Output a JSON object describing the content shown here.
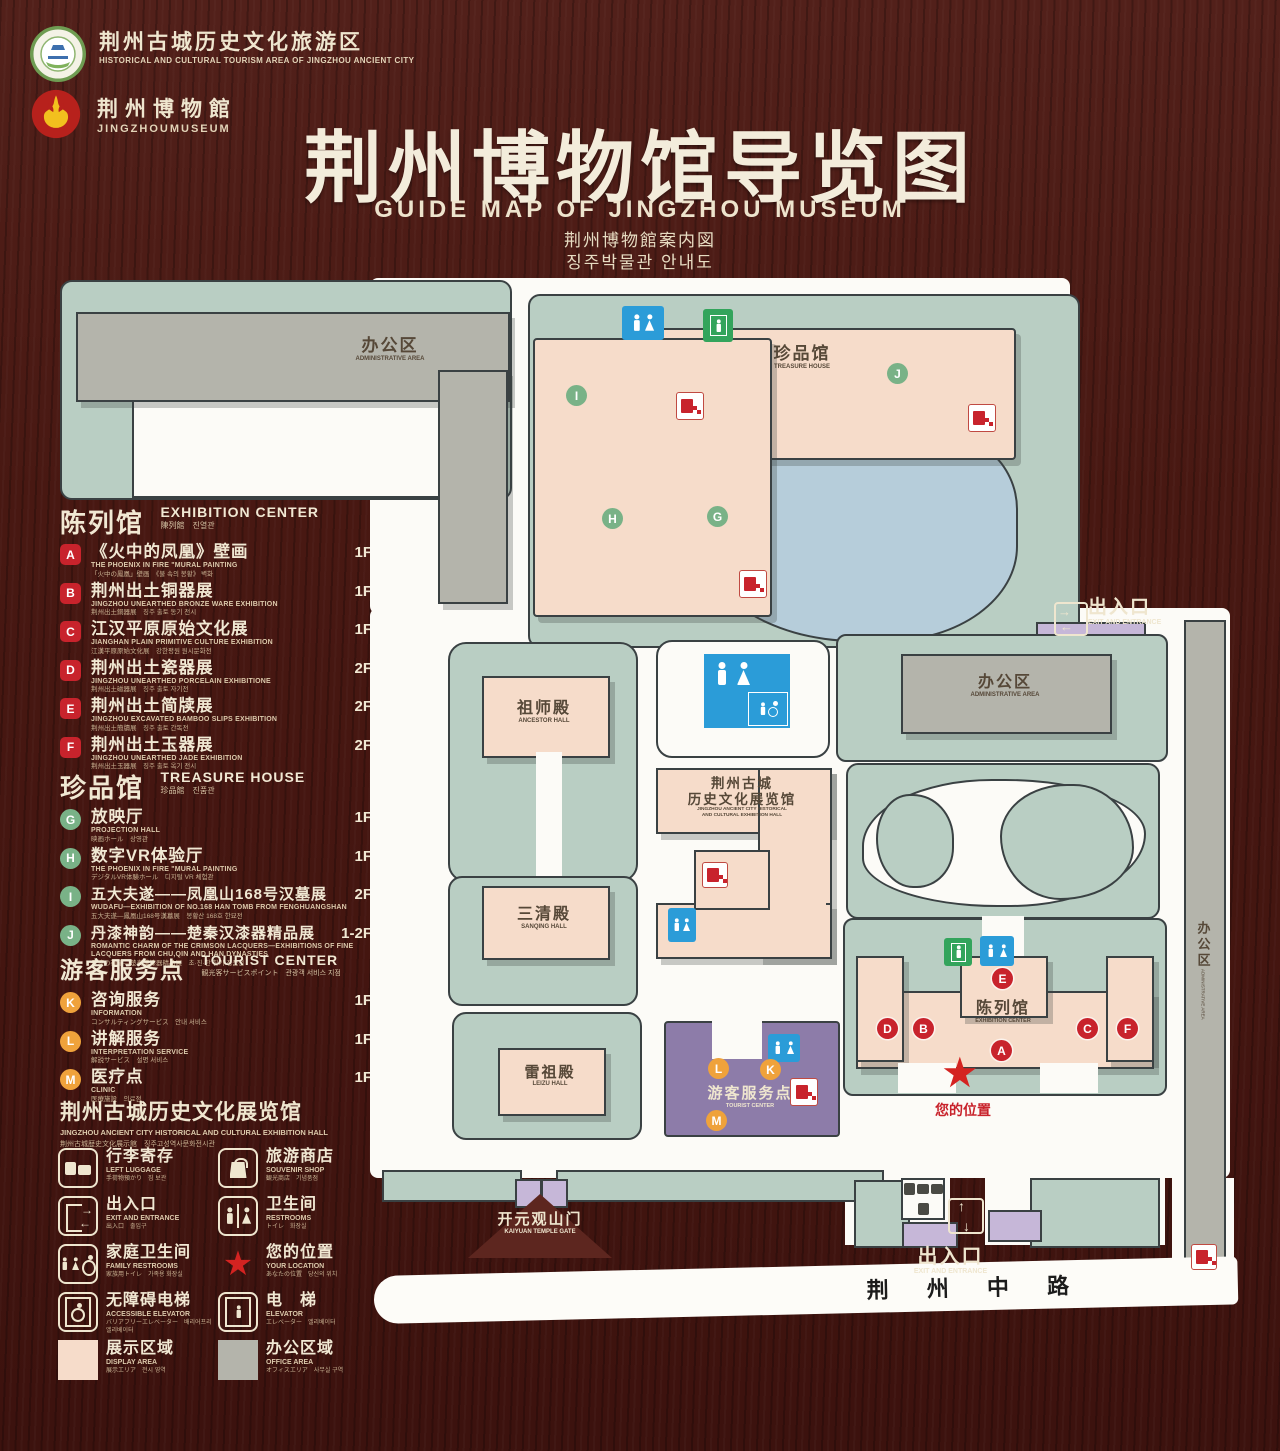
{
  "header": {
    "badge1_zh": "荆州古城历史文化旅游区",
    "badge1_en": "HISTORICAL AND CULTURAL TOURISM AREA OF JINGZHOU ANCIENT CITY",
    "badge2_zh": "荆州博物館",
    "badge2_en": "JINGZHOUMUSEUM",
    "title_zh": "荆州博物馆导览图",
    "title_en": "GUIDE MAP OF JINGZHOU MUSEUM",
    "title_ja": "荆州博物館案内図",
    "title_ko": "징주박물관 안내도"
  },
  "legend": {
    "sections": [
      {
        "title_zh": "陈列馆",
        "title_en": "EXHIBITION CENTER",
        "title_sub": "陳列館　진열관",
        "items": [
          {
            "key": "A",
            "zh": "《火中的凤凰》壁画",
            "en": "THE PHOENIX IN FIRE \"MURAL PAINTING",
            "sub": "「火中の鳳凰」壁画　《불 속의 봉황》 벽화",
            "floor": "1F"
          },
          {
            "key": "B",
            "zh": "荆州出土铜器展",
            "en": "JINGZHOU UNEARTHED BRONZE WARE EXHIBITION",
            "sub": "荆州出土銅器展　징주 출토 동기 전시",
            "floor": "1F"
          },
          {
            "key": "C",
            "zh": "江汉平原原始文化展",
            "en": "JIANGHAN PLAIN PRIMITIVE CULTURE EXHIBITION",
            "sub": "江漢平原原始文化展　강한평원 원시문화전",
            "floor": "1F"
          },
          {
            "key": "D",
            "zh": "荆州出土瓷器展",
            "en": "JINGZHOU UNEARTHED PORCELAIN EXHIBITIONE",
            "sub": "荆州出土磁器展　징주 출토 자기전",
            "floor": "2F"
          },
          {
            "key": "E",
            "zh": "荆州出土简牍展",
            "en": "JINGZHOU EXCAVATED BAMBOO SLIPS EXHIBITION",
            "sub": "荆州出土簡牘展　징주 출토 간독전",
            "floor": "2F"
          },
          {
            "key": "F",
            "zh": "荆州出土玉器展",
            "en": "JINGZHOU UNEARTHED JADE EXHIBITION",
            "sub": "荆州出土玉器展　징주 출토 옥기 전시",
            "floor": "2F"
          }
        ]
      },
      {
        "title_zh": "珍品馆",
        "title_en": "TREASURE HOUSE",
        "title_sub": "珍品館　진품관",
        "items": [
          {
            "key": "G",
            "zh": "放映厅",
            "en": "PROJECTION HALL",
            "sub": "映画ホール　상영관",
            "floor": "1F"
          },
          {
            "key": "H",
            "zh": "数字VR体验厅",
            "en": "THE PHOENIX IN FIRE \"MURAL PAINTING",
            "sub": "デジタルVR体験ホール　디지털 VR 체험관",
            "floor": "1F"
          },
          {
            "key": "I",
            "zh": "五大夫遂——凤凰山168号汉墓展",
            "en": "WUDAFU—EXHIBITION OF NO.168 HAN TOMB FROM FENGHUANGSHAN",
            "sub": "五大夫遂—鳳凰山168号漢墓展　봉황산 168호 한묘전",
            "floor": "2F"
          },
          {
            "key": "J",
            "zh": "丹漆神韵——楚秦汉漆器精品展",
            "en": "ROMANTIC CHARM OF THE CRIMSON LACQUERS—EXHIBITIONS OF FINE LACQUERS FROM CHU,QIN AND HAN DYNASTIES",
            "sub": "丹漆の神韻—楚秦漢漆器精品展　초·진·한 칠기 정품전",
            "floor": "1-2F"
          }
        ]
      },
      {
        "title_zh": "游客服务点",
        "title_en": "TOURIST CENTER",
        "title_sub": "観光客サービスポイント　관광객 서비스 지점",
        "items": [
          {
            "key": "K",
            "zh": "咨询服务",
            "en": "INFORMATION",
            "sub": "コンサルティングサービス　안내 서비스",
            "floor": "1F"
          },
          {
            "key": "L",
            "zh": "讲解服务",
            "en": "INTERPRETATION SERVICE",
            "sub": "解説サービス　설명 서비스",
            "floor": "1F"
          },
          {
            "key": "M",
            "zh": "医疗点",
            "en": "CLINIC",
            "sub": "医療施設　의료점",
            "floor": "1F"
          }
        ]
      }
    ],
    "hall_heading": {
      "zh": "荆州古城历史文化展览馆",
      "en": "JINGZHOU ANCIENT CITY HISTORICAL AND CULTURAL EXHIBITION HALL",
      "sub": "荆州古城歴史文化展示館　징주고성역사문화전시관"
    },
    "facilities": [
      {
        "zh": "行李寄存",
        "en": "LEFT LUGGAGE",
        "sub": "手荷物預かり　짐 보관"
      },
      {
        "zh": "旅游商店",
        "en": "SOUVENIR SHOP",
        "sub": "観光商店　기념품점"
      },
      {
        "zh": "出入口",
        "en": "EXIT AND ENTRANCE",
        "sub": "出入口　출입구"
      },
      {
        "zh": "卫生间",
        "en": "RESTROOMS",
        "sub": "トイレ　화장실"
      },
      {
        "zh": "家庭卫生间",
        "en": "FAMILY RESTROOMS",
        "sub": "家族用トイレ　가족용 화장실"
      },
      {
        "zh": "您的位置",
        "en": "YOUR LOCATION",
        "sub": "あなたの位置　당신의 위치"
      },
      {
        "zh": "无障碍电梯",
        "en": "ACCESSIBLE ELEVATOR",
        "sub": "バリアフリーエレベーター　배리어프리 엘리베이터"
      },
      {
        "zh": "电　梯",
        "en": "ELEVATOR",
        "sub": "エレベーター　엘리베이터"
      },
      {
        "zh": "展示区域",
        "en": "DISPLAY AREA",
        "sub": "展示エリア　전시 영역"
      },
      {
        "zh": "办公区域",
        "en": "OFFICE AREA",
        "sub": "オフィスエリア　사무실 구역"
      }
    ]
  },
  "map": {
    "admin_nw": {
      "zh": "办公区",
      "en": "ADMINISTRATIVE AREA"
    },
    "treasure": {
      "zh": "珍品馆",
      "en": "TREASURE HOUSE"
    },
    "exit_east": {
      "zh": "出入口",
      "en": "EXIT AND ENTRANCE"
    },
    "admin_east": {
      "zh": "办公区",
      "en": "ADMINISTRATIVE AREA"
    },
    "ancestor": {
      "zh": "祖师殿",
      "en": "ANCESTOR HALL"
    },
    "sanqing": {
      "zh": "三清殿",
      "en": "SANQING HALL"
    },
    "leizu": {
      "zh": "雷祖殿",
      "en": "LEIZU HALL"
    },
    "exhibition_hall": {
      "zh1": "荆州古城",
      "zh2": "历史文化展览馆",
      "en1": "JINGZHOU ANCIENT CITY HISTORICAL",
      "en2": "AND CULTURAL EXHIBITION HALL"
    },
    "exhibition_center": {
      "zh": "陈列馆",
      "en": "EXHIBITION CENTER"
    },
    "tourist": {
      "zh": "游客服务点",
      "en": "TOURIST CENTER"
    },
    "your_location": "您的位置",
    "kaiyuan": {
      "zh": "开元观山门",
      "en": "KAIYUAN TEMPLE GATE"
    },
    "exit_south": {
      "zh": "出入口",
      "en": "EXIT AND ENTRANCE"
    },
    "admin_strip": {
      "zh": "办公区",
      "en": "ADMINISTRATIVE AREA"
    },
    "road": "荆 州 中 路",
    "markers": {
      "a": "A",
      "b": "B",
      "c": "C",
      "d": "D",
      "e": "E",
      "f": "F",
      "g": "G",
      "h": "H",
      "i": "I",
      "j": "J",
      "k": "K",
      "l": "L",
      "m": "M"
    }
  }
}
